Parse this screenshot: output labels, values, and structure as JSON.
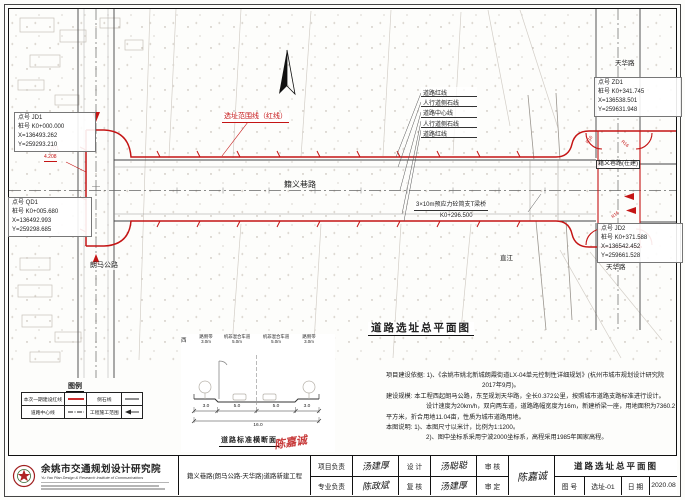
{
  "sheet": {
    "plan_title": "道路选址总平面图"
  },
  "map": {
    "red_boundary_label": "选址范围线（红线）",
    "line_labels": [
      "道路红线",
      "人行道侧石线",
      "道路中心线",
      "人行道侧石线",
      "道路红线"
    ],
    "main_road": "籍义巷路",
    "langma_road": "朗马公路",
    "tianhua_top": "天华路",
    "tianhua_bottom": "天华路",
    "under_construction": "籍义巷路(在建)",
    "river": "直江",
    "bridge_line1": "3×10m预应力砼简支T梁桥",
    "bridge_line2": "K0+296.500",
    "jd1_tag": "JD1",
    "jd1_elev": "4.208",
    "r16": "R16",
    "points": {
      "jd1": {
        "l1": "点号  JD1",
        "l2": "桩号 K0+000.000",
        "l3": "X=136493.262",
        "l4": "Y=259293.210"
      },
      "qd1": {
        "l1": "点号  QD1",
        "l2": "桩号 K0+005.680",
        "l3": "X=136492.993",
        "l4": "Y=259298.685"
      },
      "zd1": {
        "l1": "点号  ZD1",
        "l2": "桩号 K0+341.745",
        "l3": "X=136538.501",
        "l4": "Y=259631.948"
      },
      "jd2": {
        "l1": "点号  JD2",
        "l2": "桩号 K0+371.588",
        "l3": "X=136542.452",
        "l4": "Y=259661.528"
      }
    }
  },
  "legend": {
    "title": "图例",
    "row1_label1": "本次一期建设红线",
    "row1_label2": "侧石线",
    "row2_label1": "道路中心线",
    "row2_label2": "工程施工范围"
  },
  "cross_section": {
    "title": "道路标准横断面",
    "west": "西",
    "seg1_name": "路侧带",
    "seg1_w": "3.0m",
    "seg2_name": "机非混合车道",
    "seg2_w": "5.0m",
    "seg3_name": "机非混合车道",
    "seg3_w": "5.0m",
    "seg4_name": "路侧带",
    "seg4_w": "3.0m",
    "dim1": "3.0",
    "dim2": "5.0",
    "dim3": "5.0",
    "dim4": "3.0",
    "total": "16.0"
  },
  "notes": {
    "lines": [
      "项目建设依据: 1)、《余姚市姚北新城朗霞街道LX-04单元控制性详细规划》(杭州市城市规划设计研究院",
      "2017年9月)。",
      "建设规模: 本工程西起朗马公路，东至规划天华路，全长0.372公里，按照城市道路支路标准进行设计。",
      "设计速度为20km/h，双向两车道，道路路幅宽度为16m，新建桥梁一座，用地面积为7360.2",
      "平方米，折合用地11.04亩，性质为城市道路用地。",
      "本图说明: 1)、本图尺寸以米计，比例为1:1200。",
      "2)、图中坐标系采用宁波2000坐标系，高程采用1985年国家高程。"
    ]
  },
  "titleblock": {
    "institute_cn": "余姚市交通规划设计研究院",
    "institute_en": "Yu Yao Plan Design & Research Institute of Communications",
    "project_name": "籍义巷路(朗马公路-天华路)道路新建工程",
    "row1": {
      "c1": "项目负责",
      "s1": "汤建厚",
      "c2": "设 计",
      "s2": "汤聪聪",
      "c3": "审 核"
    },
    "row2": {
      "c1": "专业负责",
      "s1": "陈政斌",
      "c2": "复 核",
      "s2": "汤建厚",
      "c3": "审 定"
    },
    "span_sign": "陈嘉诚",
    "drawing_title": "道路选址总平面图",
    "no_label": "图 号",
    "no_value": "选址-01",
    "date_label": "日 期",
    "date_value": "2020.08",
    "stamp": "陈嘉诚"
  }
}
